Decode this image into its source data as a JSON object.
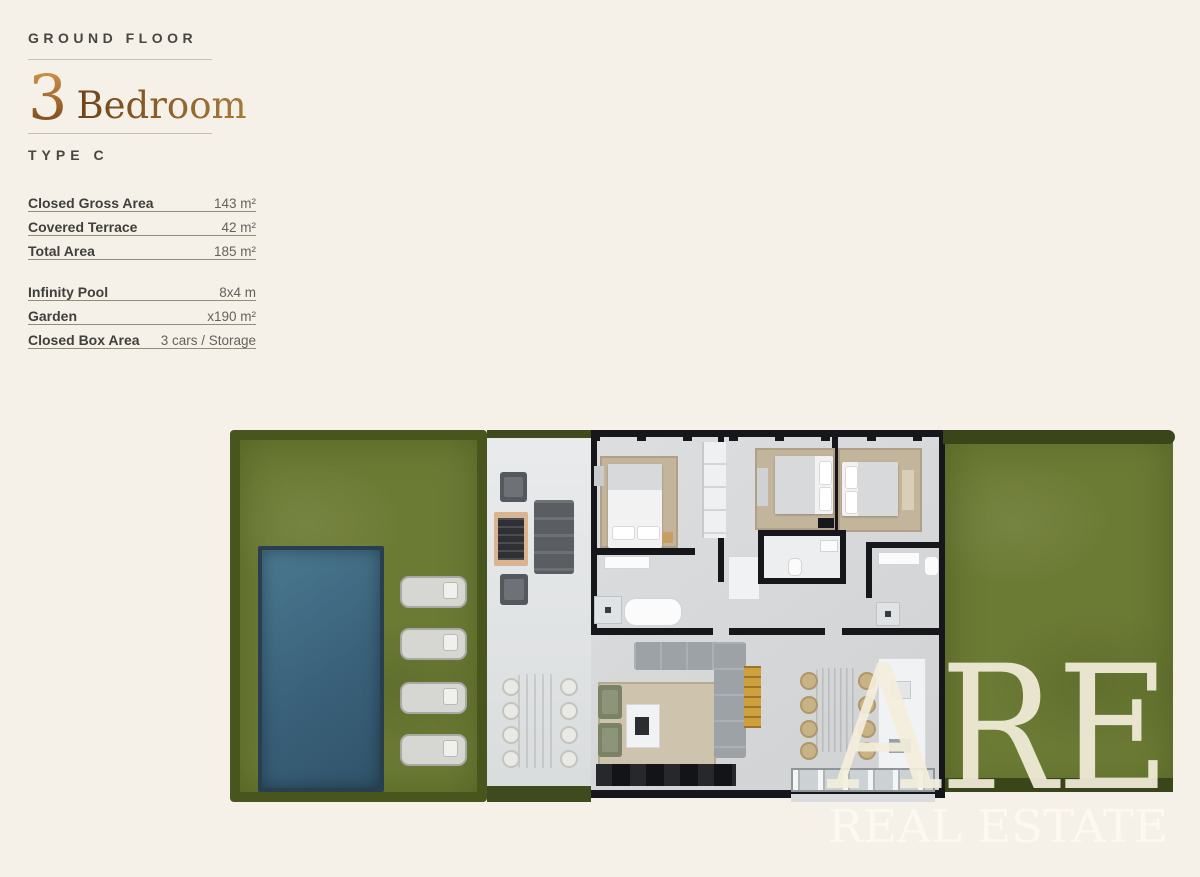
{
  "header": {
    "floor_label": "GROUND FLOOR",
    "bedrooms_number": "3",
    "bedrooms_word": "Bedroom",
    "type_label": "TYPE C"
  },
  "specs": {
    "area_rows": [
      {
        "label": "Closed Gross Area",
        "value": "143 m²"
      },
      {
        "label": "Covered Terrace",
        "value": "42 m²"
      },
      {
        "label": "Total Area",
        "value": "185 m²"
      }
    ],
    "feature_rows": [
      {
        "label": "Infinity Pool",
        "value": "8x4 m"
      },
      {
        "label": "Garden",
        "value": "x190 m²"
      },
      {
        "label": "Closed Box Area",
        "value": "3 cars / Storage"
      }
    ]
  },
  "watermark": {
    "initials": "ARE",
    "name": "REAL ESTATE"
  },
  "colors": {
    "background": "#f5f1e8",
    "accent_copper": "#a06a2c",
    "grass": "#6c7b34",
    "hedge": "#46531c",
    "pool": "#3a617a",
    "terrace": "#e2e4e5",
    "wall": "#17171b",
    "text_dark": "#474642",
    "text_muted": "#63625e"
  }
}
